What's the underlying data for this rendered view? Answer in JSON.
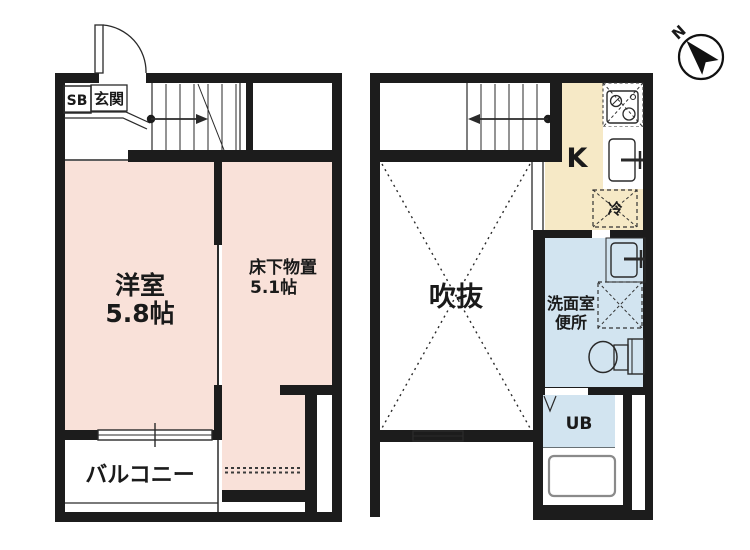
{
  "colors": {
    "wall": "#1c1c1c",
    "room_pink": "#f9e1d9",
    "kitchen_cream": "#f6e9c6",
    "wet_blue": "#d2e4f0",
    "line": "#333333",
    "tub_outline": "#8a8a8a"
  },
  "floor1": {
    "shoe_box": "SB",
    "entrance": "玄関",
    "room_name": "洋室",
    "room_size": "5.8帖",
    "storage_name": "床下物置",
    "storage_size": "5.1帖",
    "balcony": "バルコニー"
  },
  "floor2": {
    "kitchen": "K",
    "refrigerator": "冷",
    "void": "吹抜",
    "washroom": "洗面室",
    "toilet": "便所",
    "unit_bath": "UB"
  },
  "compass": {
    "north": "N"
  }
}
